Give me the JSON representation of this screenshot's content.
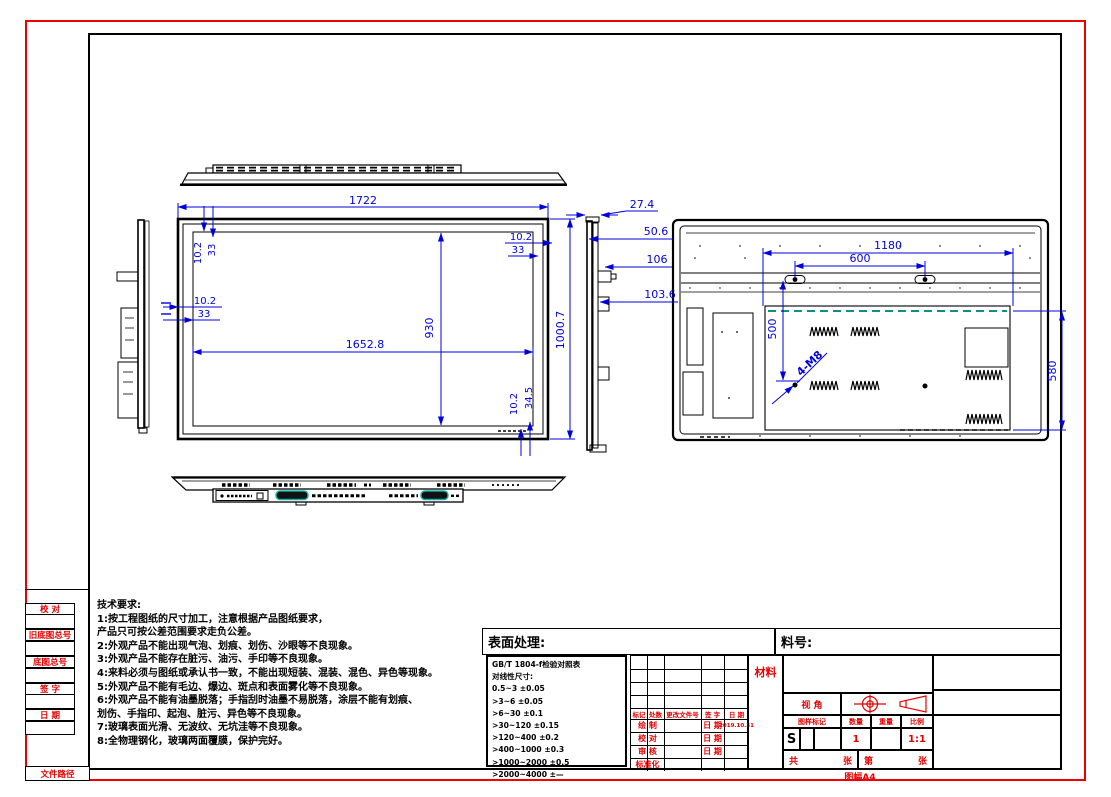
{
  "colors": {
    "border_red": "#ee0000",
    "dim_blue": "#0000dd",
    "line_black": "#000000",
    "teal": "#0e8f86"
  },
  "sidebar": {
    "labels": [
      "校 对",
      "旧底图总号",
      "底图总号",
      "签 字",
      "日 期",
      "文件路径"
    ]
  },
  "tech": {
    "title": "技术要求:",
    "lines": [
      "1:按工程图纸的尺寸加工，注意根据产品图纸要求，",
      "产品只可按公差范围要求走负公差。",
      "2:外观产品不能出现气泡、划痕、划伤、沙眼等不良现象。",
      "3:外观产品不能存在脏污、油污、手印等不良现象。",
      "4:来料必须与图纸或承认书一致，不能出现短装、混装、混色、异色等现象。",
      "5:外观产品不能有毛边、爆边、斑点和表面雾化等不良现象。",
      "6:外观产品不能有油墨脱落；手指刮时油墨不易脱落，涂层不能有划痕、",
      "划伤、手指印、起泡、脏污、异色等不良现象。",
      "7:玻璃表面光滑、无波纹、无坑洼等不良现象。",
      "8:全物理钢化，玻璃两面覆膜，保护完好。"
    ]
  },
  "dims": {
    "w": "1722",
    "iw": "1652.8",
    "ih": "930",
    "h": "1000.7",
    "b1": "10.2",
    "b2": "33",
    "b3": "34.5",
    "s1": "27.4",
    "s2": "50.6",
    "s3": "106",
    "s4": "103.6",
    "r1": "1180",
    "r2": "600",
    "r3": "500",
    "r4": "580",
    "holes": "4-M8"
  },
  "title_block": {
    "surface_label": "表面处理:",
    "part_label": "料号:",
    "material": "材料",
    "tolerance_title": "GB/T 1804-f检验对照表",
    "tolerance_subtitle": "对线性尺寸:",
    "tolerance_rows": [
      "0.5~3  ±0.05",
      ">3~6  ±0.05",
      ">6~30  ±0.1",
      ">30~120  ±0.15",
      ">120~400  ±0.2",
      ">400~1000  ±0.3",
      ">1000~2000  ±0.5",
      ">2000~4000  ±—"
    ],
    "change_headers": [
      "标记",
      "处数",
      "更改文件号",
      "签 字",
      "日 期"
    ],
    "row_draw": "绘 制",
    "row_check": "校 对",
    "row_audit": "审 核",
    "row_std": "标准化",
    "date_label": "日 期",
    "draw_date": "2019.10.31",
    "view_label": "视 角",
    "stamp_header": "图样标记",
    "qty_header": "数量",
    "weight_header": "重量",
    "scale_header": "比例",
    "stamp_value": "S",
    "qty_value": "1",
    "scale_value": "1:1",
    "total_label": "共",
    "sheet_unit": "张",
    "no_label": "第",
    "sheet_unit2": "张",
    "format": "图幅A4"
  }
}
